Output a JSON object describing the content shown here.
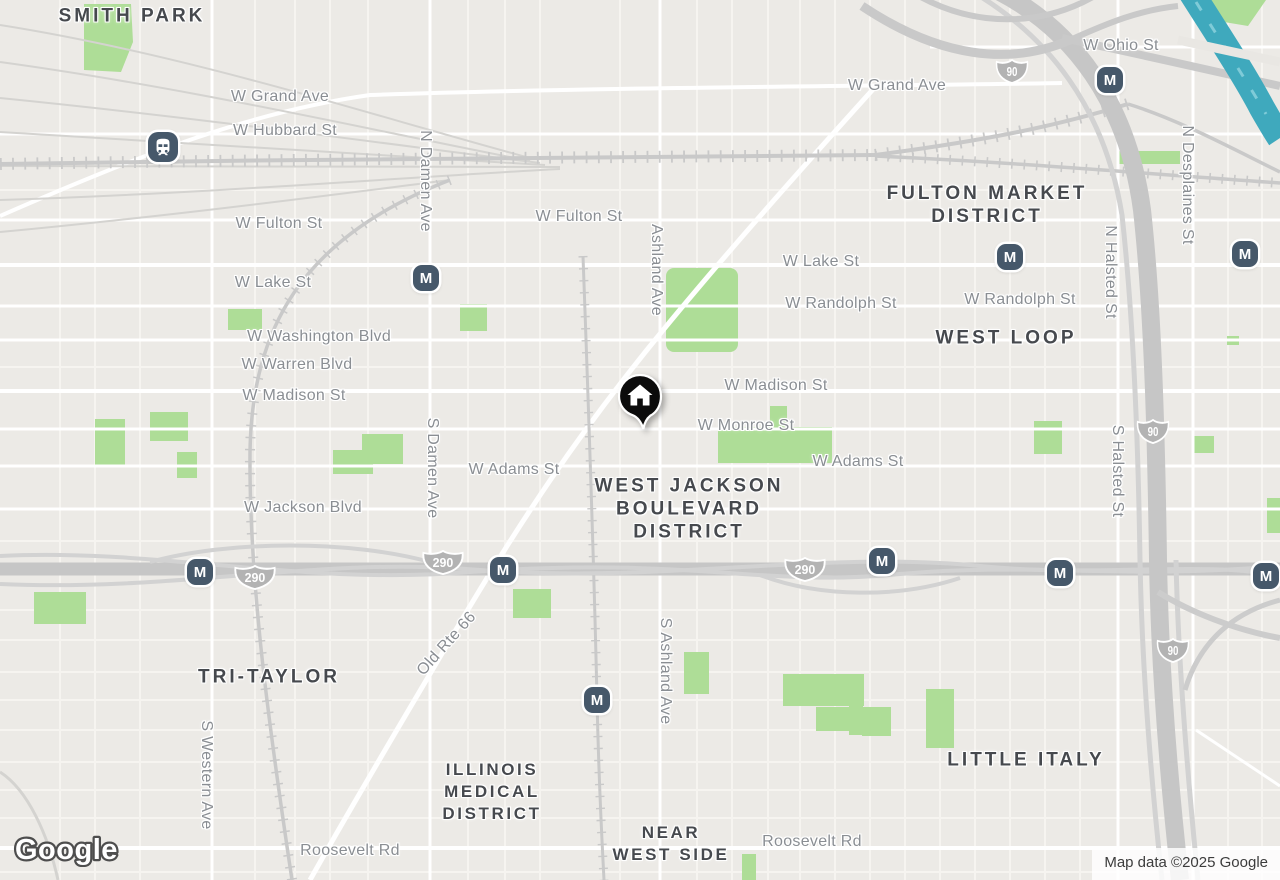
{
  "map": {
    "attribution": "Map data ©2025 Google",
    "logo": "Google",
    "colors": {
      "background": "#eceae6",
      "road_minor": "#f6f4f0",
      "road_arterial": "#ffffff",
      "highway": "#c6c6c6",
      "railway": "#c9c9c9",
      "park": "#aedd97",
      "water": "#3fa9bd",
      "street_label": "#8a8e93",
      "district_label": "#46494e",
      "transit_badge": "#46586a",
      "shield": "#b3b3b3",
      "home_pin": "#0b0b0b"
    },
    "street_labels": [
      {
        "text": "W Grand Ave",
        "x": 280,
        "y": 97
      },
      {
        "text": "W Hubbard St",
        "x": 285,
        "y": 131
      },
      {
        "text": "W Fulton St",
        "x": 279,
        "y": 224
      },
      {
        "text": "W Lake St",
        "x": 273,
        "y": 283
      },
      {
        "text": "W Washington Blvd",
        "x": 319,
        "y": 337
      },
      {
        "text": "W Warren Blvd",
        "x": 297,
        "y": 365
      },
      {
        "text": "W Madison St",
        "x": 294,
        "y": 396
      },
      {
        "text": "W Adams St",
        "x": 514,
        "y": 470
      },
      {
        "text": "W Jackson Blvd",
        "x": 303,
        "y": 508
      },
      {
        "text": "N Damen Ave",
        "x": 425,
        "y": 181,
        "rot": 90
      },
      {
        "text": "S Damen Ave",
        "x": 432,
        "y": 468,
        "rot": 90
      },
      {
        "text": "W Fulton St",
        "x": 579,
        "y": 217
      },
      {
        "text": "Ashland Ave",
        "x": 656,
        "y": 270,
        "rot": 90
      },
      {
        "text": "S Ashland Ave",
        "x": 665,
        "y": 671,
        "rot": 90
      },
      {
        "text": "W Lake St",
        "x": 821,
        "y": 262
      },
      {
        "text": "W Randolph St",
        "x": 841,
        "y": 304
      },
      {
        "text": "W Madison St",
        "x": 776,
        "y": 386
      },
      {
        "text": "W Monroe St",
        "x": 746,
        "y": 426
      },
      {
        "text": "W Adams St",
        "x": 858,
        "y": 462
      },
      {
        "text": "W Grand Ave",
        "x": 897,
        "y": 86
      },
      {
        "text": "W Ohio St",
        "x": 1121,
        "y": 46
      },
      {
        "text": "W Randolph St",
        "x": 1020,
        "y": 300
      },
      {
        "text": "N Desplaines St",
        "x": 1187,
        "y": 185,
        "rot": 90
      },
      {
        "text": "N Halsted St",
        "x": 1110,
        "y": 272,
        "rot": 90
      },
      {
        "text": "S Halsted St",
        "x": 1117,
        "y": 471,
        "rot": 90
      },
      {
        "text": "S Western Ave",
        "x": 206,
        "y": 775,
        "rot": 90
      },
      {
        "text": "Old Rte 66",
        "x": 447,
        "y": 644,
        "rot": -48
      },
      {
        "text": "Roosevelt Rd",
        "x": 350,
        "y": 851
      },
      {
        "text": "Roosevelt Rd",
        "x": 812,
        "y": 842
      }
    ],
    "district_labels": [
      {
        "lines": [
          "SMITH PARK"
        ],
        "x": 132,
        "y": 16,
        "size": "lg"
      },
      {
        "lines": [
          "FULTON MARKET",
          "DISTRICT"
        ],
        "x": 987,
        "y": 205,
        "size": "lg"
      },
      {
        "lines": [
          "WEST LOOP"
        ],
        "x": 1006,
        "y": 338,
        "size": "lg"
      },
      {
        "lines": [
          "WEST JACKSON",
          "BOULEVARD",
          "DISTRICT"
        ],
        "x": 689,
        "y": 509,
        "size": "lg"
      },
      {
        "lines": [
          "TRI-TAYLOR"
        ],
        "x": 269,
        "y": 677,
        "size": "lg"
      },
      {
        "lines": [
          "ILLINOIS",
          "MEDICAL",
          "DISTRICT"
        ],
        "x": 492,
        "y": 792,
        "size": "md"
      },
      {
        "lines": [
          "NEAR",
          "WEST SIDE"
        ],
        "x": 671,
        "y": 844,
        "size": "md"
      },
      {
        "lines": [
          "LITTLE ITALY"
        ],
        "x": 1026,
        "y": 760,
        "size": "lg"
      }
    ],
    "transit_markers": [
      {
        "kind": "train",
        "x": 163,
        "y": 147
      },
      {
        "kind": "m",
        "label": "M",
        "x": 426,
        "y": 278
      },
      {
        "kind": "m",
        "label": "M",
        "x": 1110,
        "y": 80
      },
      {
        "kind": "m",
        "label": "M",
        "x": 1010,
        "y": 257
      },
      {
        "kind": "m",
        "label": "M",
        "x": 1245,
        "y": 254
      },
      {
        "kind": "m",
        "label": "M",
        "x": 200,
        "y": 572
      },
      {
        "kind": "m",
        "label": "M",
        "x": 503,
        "y": 570
      },
      {
        "kind": "m",
        "label": "M",
        "x": 882,
        "y": 561
      },
      {
        "kind": "m",
        "label": "M",
        "x": 1060,
        "y": 573
      },
      {
        "kind": "m",
        "label": "M",
        "x": 1266,
        "y": 576
      },
      {
        "kind": "m",
        "label": "M",
        "x": 597,
        "y": 700
      }
    ],
    "highway_shields": [
      {
        "route": "90",
        "x": 1012,
        "y": 74
      },
      {
        "route": "90",
        "x": 1153,
        "y": 434
      },
      {
        "route": "90",
        "x": 1173,
        "y": 653
      },
      {
        "route": "290",
        "x": 255,
        "y": 580
      },
      {
        "route": "290",
        "x": 443,
        "y": 565
      },
      {
        "route": "290",
        "x": 805,
        "y": 572
      }
    ],
    "home_marker": {
      "x": 640,
      "y": 396
    }
  }
}
